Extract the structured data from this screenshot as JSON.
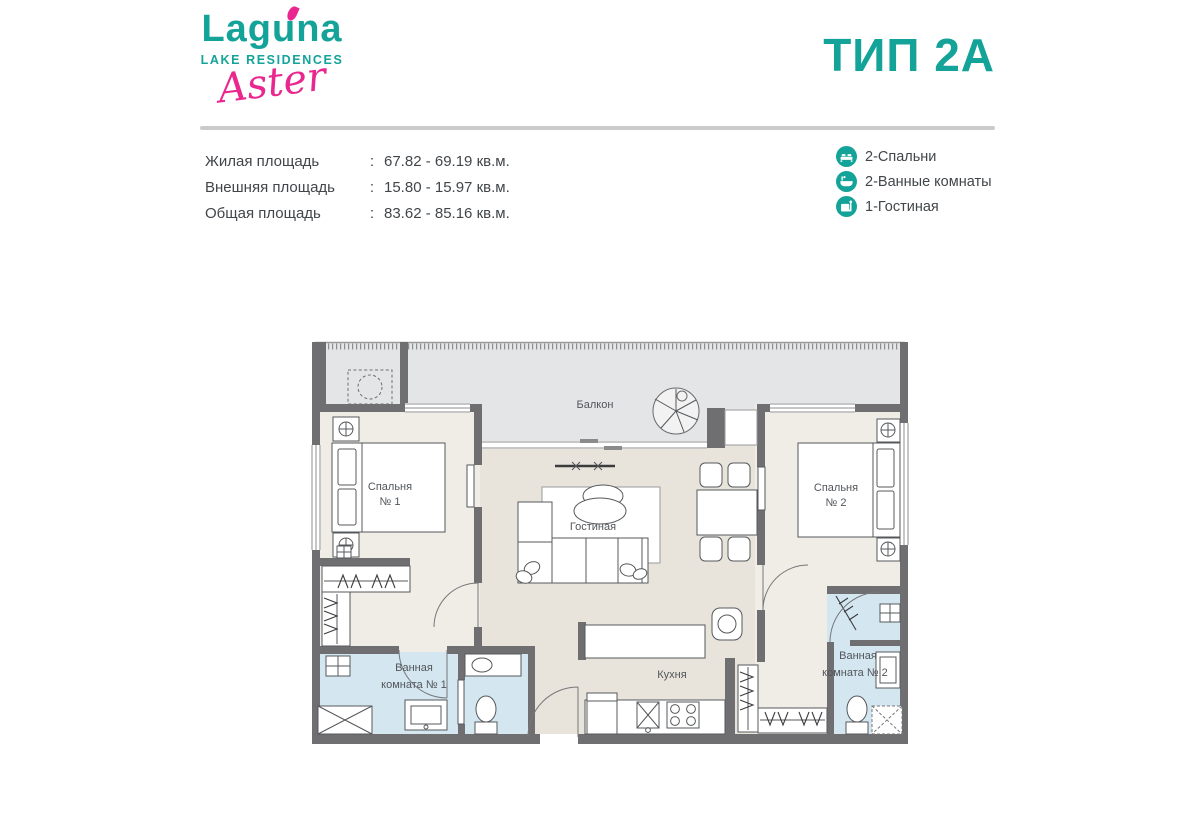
{
  "header": {
    "logo_main": "Laguna",
    "logo_sub": "LAKE RESIDENCES",
    "logo_script": "Aster",
    "title": "ТИП 2А"
  },
  "specs": {
    "rows": [
      {
        "label": "Жилая площадь",
        "sep": ":",
        "value": "67.82 - 69.19 кв.м."
      },
      {
        "label": "Внешняя площадь",
        "sep": ":",
        "value": "15.80 - 15.97 кв.м."
      },
      {
        "label": "Общая площадь",
        "sep": ":",
        "value": "83.62 - 85.16 кв.м."
      }
    ]
  },
  "legend": {
    "items": [
      {
        "icon": "bed-icon",
        "label": "2-Спальни"
      },
      {
        "icon": "bathtub-icon",
        "label": "2-Ванные комнаты"
      },
      {
        "icon": "armchair-icon",
        "label": "1-Гостиная"
      }
    ]
  },
  "floorplan": {
    "labels": {
      "balcony": "Балкон",
      "bedroom1_l1": "Спальня",
      "bedroom1_l2": "№ 1",
      "living": "Гостиная",
      "bedroom2_l1": "Спальня",
      "bedroom2_l2": "№ 2",
      "bath1_l1": "Ванная",
      "bath1_l2": "комната № 1",
      "kitchen": "Кухня",
      "bath2_l1": "Ванная",
      "bath2_l2": "комната № 2"
    },
    "colors": {
      "wall": "#6f6f71",
      "floor_living": "#e8e4dc",
      "floor_bedroom": "#f0ede7",
      "floor_bath": "#d4e6f0",
      "floor_balcony": "#e3e5e7"
    }
  },
  "colors": {
    "teal": "#14a398",
    "pink": "#e9278e",
    "text": "#3f4448",
    "divider": "#c9cbcc"
  }
}
